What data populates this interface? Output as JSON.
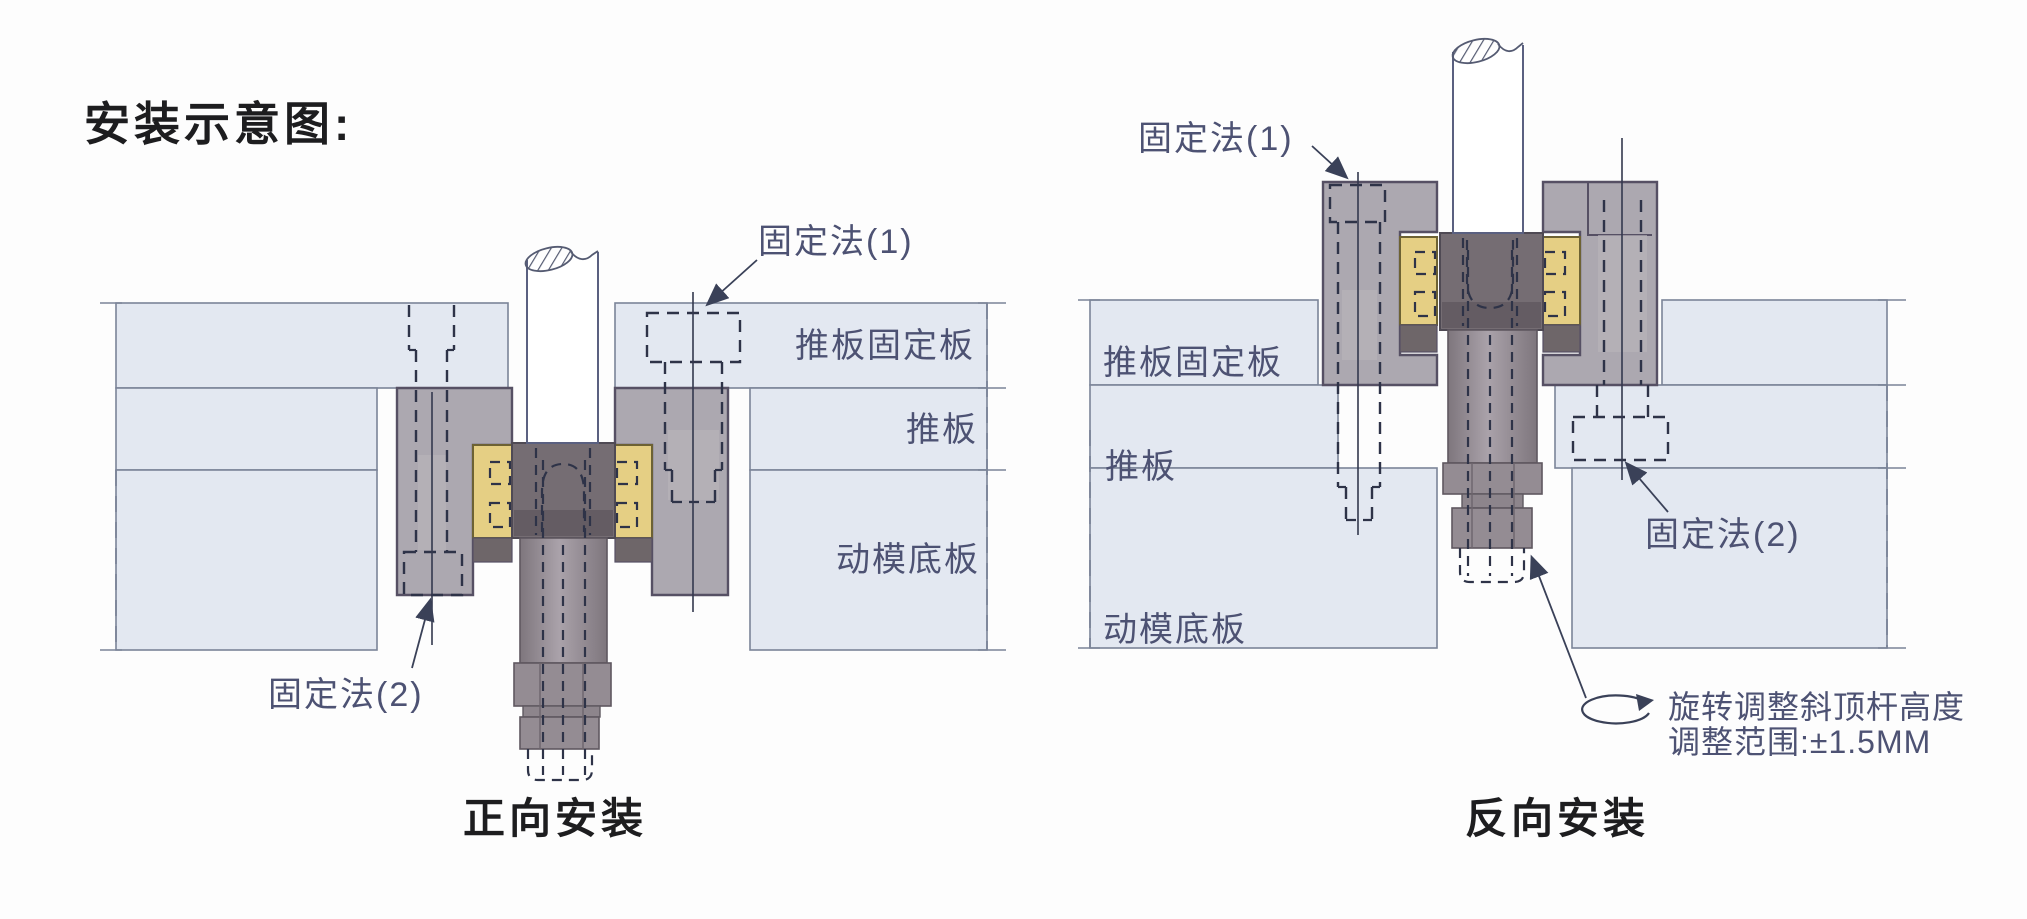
{
  "title": "安装示意图:",
  "colors": {
    "label_text": "#4d5273",
    "title_text": "#1d1d1f",
    "plate_fill": "#e3e8f1",
    "plate_stroke": "#7b8498",
    "block_fill": "#a9a4ad",
    "tnut_fill": "#756d73",
    "slider_yellow": "#e5cf84",
    "screw_fill": "#8d858c",
    "dash_color": "#2e3348"
  },
  "left_diagram": {
    "caption": "正向安装",
    "labels": {
      "fixing1": "固定法(1)",
      "fixing2": "固定法(2)",
      "plate_retainer": "推板固定板",
      "plate_push": "推板",
      "plate_base": "动模底板"
    }
  },
  "right_diagram": {
    "caption": "反向安装",
    "labels": {
      "fixing1": "固定法(1)",
      "fixing2": "固定法(2)",
      "plate_retainer": "推板固定板",
      "plate_push": "推板",
      "plate_base": "动模底板"
    },
    "rotation_note": {
      "line1": "旋转调整斜顶杆高度",
      "line2": "调整范围:±1.5MM"
    }
  }
}
